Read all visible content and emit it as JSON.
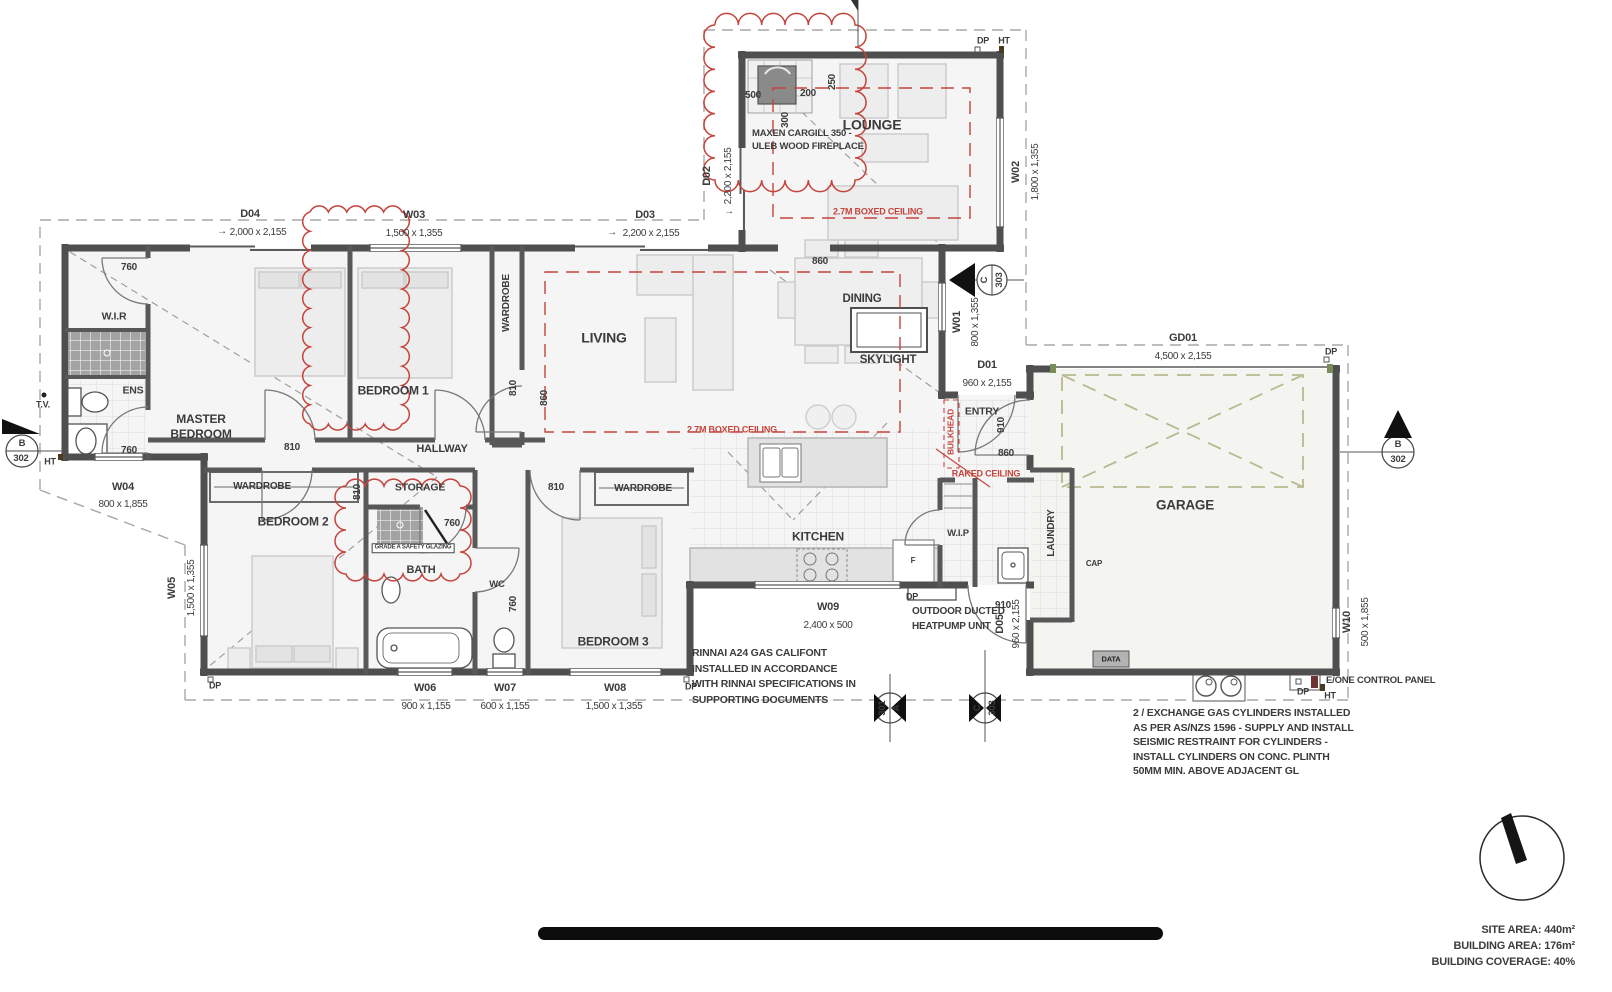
{
  "arrow": "→",
  "rooms": {
    "lounge": "LOUNGE",
    "living": "LIVING",
    "dining": "DINING",
    "skylight": "SKYLIGHT",
    "master_bedroom": "MASTER\nBEDROOM",
    "bedroom1": "BEDROOM 1",
    "bedroom2": "BEDROOM 2",
    "bedroom3": "BEDROOM 3",
    "wir": "W.I.R",
    "ens": "ENS",
    "hallway": "HALLWAY",
    "wardrobe": "WARDROBE",
    "storage": "STORAGE",
    "bath": "BATH",
    "wc": "WC",
    "kitchen": "KITCHEN",
    "wip": "W.I.P",
    "entry": "ENTRY",
    "laundry": "LAUNDRY",
    "garage": "GARAGE",
    "fridge": "F",
    "cap": "CAP"
  },
  "openings": {
    "d01": {
      "code": "D01",
      "size": "960 x 2,155"
    },
    "d02": {
      "code": "D02",
      "size": "2,200 x 2,155"
    },
    "d03": {
      "code": "D03",
      "size": "2,200 x 2,155"
    },
    "d04": {
      "code": "D04",
      "size": "2,000 x 2,155"
    },
    "d05": {
      "code": "D05",
      "size": "960 x 2,155"
    },
    "w01": {
      "code": "W01",
      "size": "800 x 1,355"
    },
    "w02": {
      "code": "W02",
      "size": "1,800 x 1,355"
    },
    "w03": {
      "code": "W03",
      "size": "1,500 x 1,355"
    },
    "w04": {
      "code": "W04",
      "size": "800 x 1,855"
    },
    "w05": {
      "code": "W05",
      "size": "1,500 x 1,355"
    },
    "w06": {
      "code": "W06",
      "size": "900 x 1,155"
    },
    "w07": {
      "code": "W07",
      "size": "600 x 1,155"
    },
    "w08": {
      "code": "W08",
      "size": "1,500 x 1,355"
    },
    "w09": {
      "code": "W09",
      "size": "2,400 x 500"
    },
    "w10": {
      "code": "W10",
      "size": "500 x 1,855"
    },
    "gd01": {
      "code": "GD01",
      "size": "4,500 x 2,155"
    }
  },
  "dims": {
    "d760": "760",
    "d810": "810",
    "d860": "860",
    "d910": "910",
    "d500": "500",
    "d200": "200",
    "d250": "250",
    "d300": "300"
  },
  "ceiling_notes": {
    "boxed": "2.7M BOXED CEILING",
    "raked": "RAKED CEILING",
    "bulkhead": "BULKHEAD"
  },
  "notes": {
    "fireplace": "MAXEN CARGILL 350 -\nULEB WOOD FIREPLACE",
    "califont": "RINNAI A24 GAS CALIFONT\nINSTALLED IN ACCORDANCE\nWITH RINNAI SPECIFICATIONS IN\nSUPPORTING DOCUMENTS",
    "gas_cylinders": "2 / EXCHANGE GAS CYLINDERS INSTALLED\nAS PER AS/NZS 1596 - SUPPLY AND INSTALL\nSEISMIC RESTRAINT FOR CYLINDERS -\nINSTALL CYLINDERS ON CONC. PLINTH\n50MM MIN. ABOVE ADJACENT GL",
    "heatpump": "OUTDOOR DUCTED\nHEATPUMP UNIT",
    "glazing": "GRADE A SAFETY GLAZING",
    "eone": "E/ONE CONTROL PANEL",
    "data": "DATA"
  },
  "site_marks": {
    "dp": "DP",
    "ht": "HT",
    "tv": "T.V."
  },
  "section_markers": {
    "b302": {
      "letter": "B",
      "number": "302"
    },
    "c303": {
      "letter": "C",
      "number": "303"
    },
    "a301": {
      "letter": "A",
      "number": "301"
    }
  },
  "areas": {
    "site": "SITE AREA: 440m²",
    "building": "BUILDING AREA: 176m²",
    "coverage": "BUILDING COVERAGE: 40%"
  }
}
